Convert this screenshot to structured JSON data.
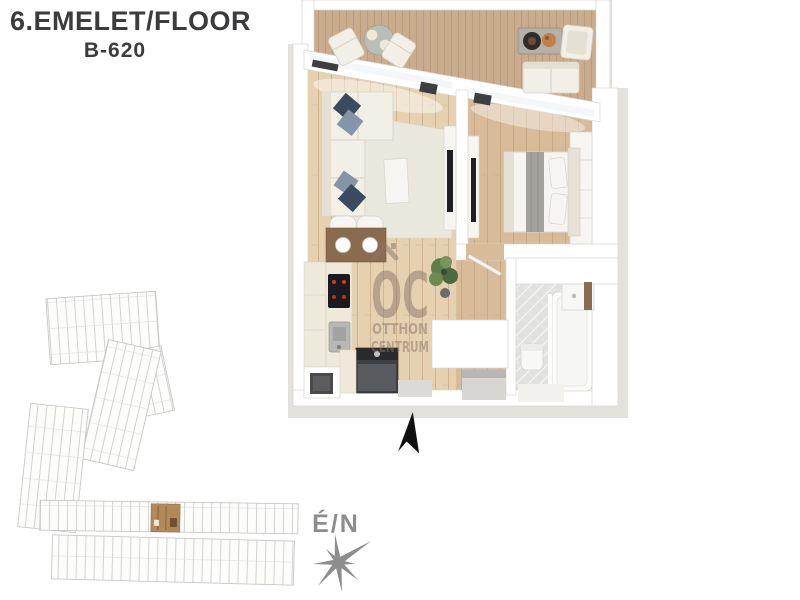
{
  "header": {
    "floor_label": "6.EMELET/FLOOR",
    "unit_label": "B-620"
  },
  "plan_watermark": {
    "logo": "OC",
    "name_line1": "OTTHON",
    "name_line2": "CENTRUM"
  },
  "compass": {
    "direction_label": "É/N"
  },
  "icons": {
    "north_arrow_icon": "▲",
    "compass_rose_icon": "✶"
  },
  "colors": {
    "title": "#3c3c3e",
    "slab": "#e3e1de",
    "wall": "#ffffff",
    "wallEdge": "#d8d5d1",
    "deck": "#c9ac8d",
    "deckLine": "#a98b68",
    "floor": "#d8bc9a",
    "floorLight": "#e5d0b0",
    "floorLine": "#b3906a",
    "rug": "#eae7dc",
    "sofa": "#f2efe7",
    "pillowNavy": "#3a4a60",
    "pillowSlate": "#8595a8",
    "tableBrown": "#8a6b4e",
    "tile": "#e1e1df",
    "tub": "#fbfbfa",
    "applianceDark": "#404247",
    "cooktop": "#17171a",
    "redDot": "#d03a2a",
    "plantGreen": "#5f7d49",
    "watermark": "#8a7767",
    "gray": "#8d8d8d",
    "black": "#101010",
    "planLine": "#c7c7c7",
    "planFill": "#fdfdfc",
    "highlight": "#b3895a"
  }
}
